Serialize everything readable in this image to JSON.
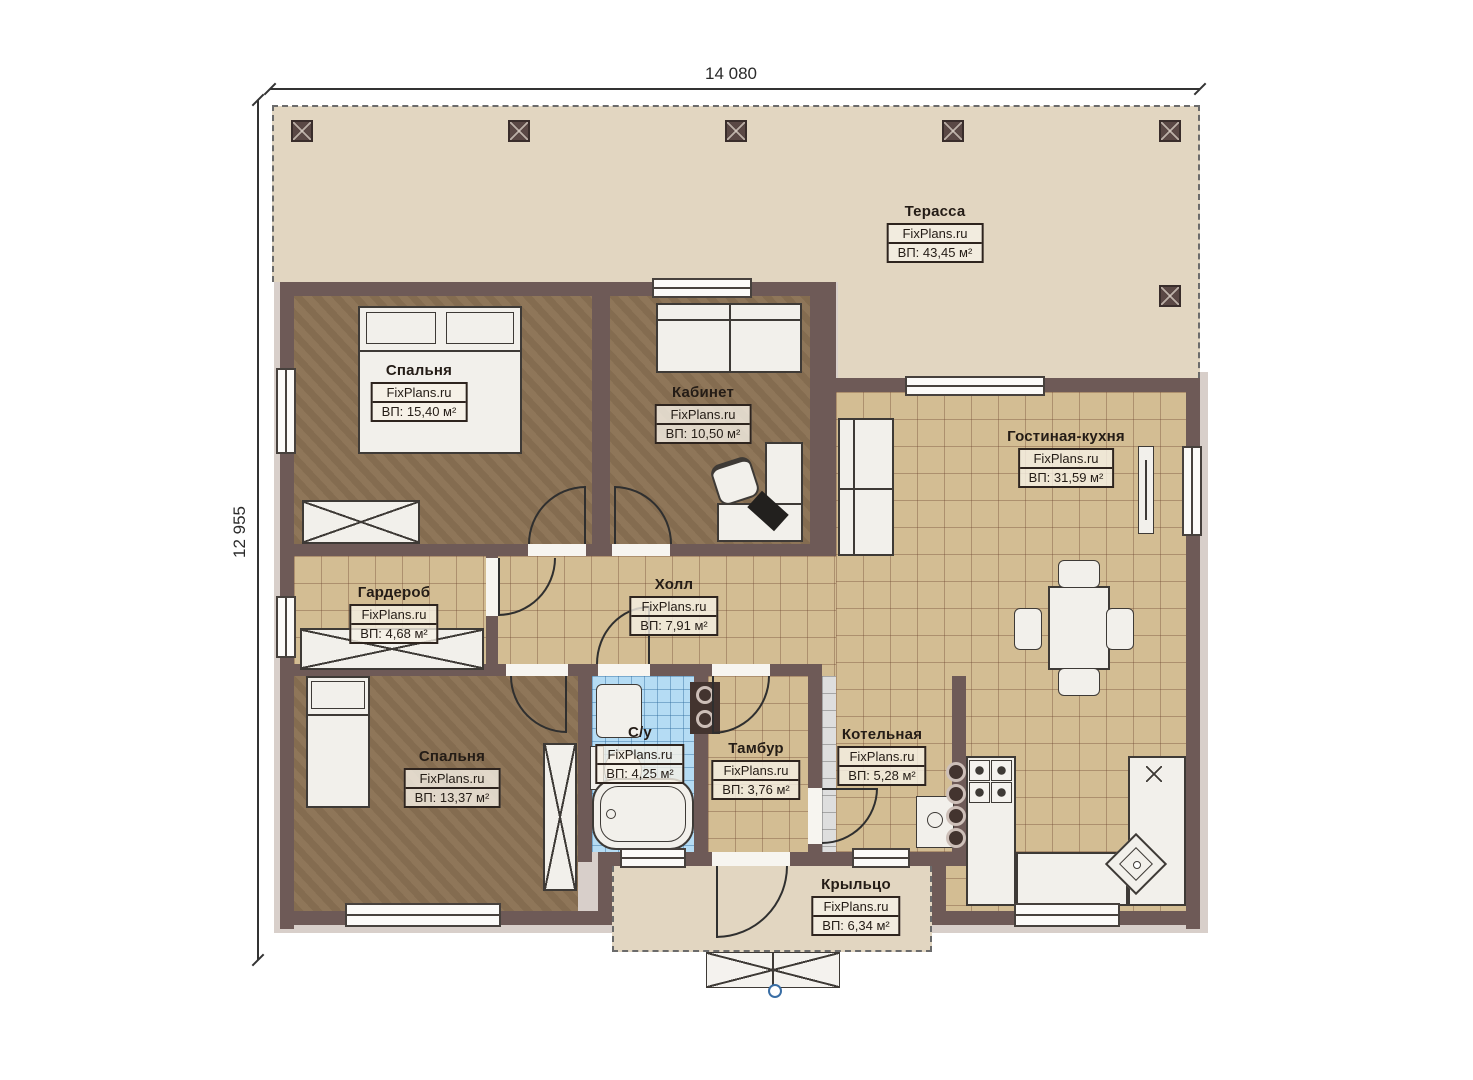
{
  "dimensions": {
    "width": "14 080",
    "height": "12 955"
  },
  "rooms": [
    {
      "id": "terrace",
      "name": "Терасса",
      "site": "FixPlans.ru",
      "area": "ВП: 43,45 м²"
    },
    {
      "id": "bedroom-1",
      "name": "Спальня",
      "site": "FixPlans.ru",
      "area": "ВП: 15,40 м²"
    },
    {
      "id": "office",
      "name": "Кабинет",
      "site": "FixPlans.ru",
      "area": "ВП: 10,50 м²"
    },
    {
      "id": "living-kitchen",
      "name": "Гостиная-кухня",
      "site": "FixPlans.ru",
      "area": "ВП: 31,59 м²"
    },
    {
      "id": "wardrobe",
      "name": "Гардероб",
      "site": "FixPlans.ru",
      "area": "ВП: 4,68 м²"
    },
    {
      "id": "hall",
      "name": "Холл",
      "site": "FixPlans.ru",
      "area": "ВП: 7,91 м²"
    },
    {
      "id": "bedroom-2",
      "name": "Спальня",
      "site": "FixPlans.ru",
      "area": "ВП: 13,37 м²"
    },
    {
      "id": "bathroom",
      "name": "С/у",
      "site": "FixPlans.ru",
      "area": "ВП: 4,25 м²"
    },
    {
      "id": "vestibule",
      "name": "Тамбур",
      "site": "FixPlans.ru",
      "area": "ВП: 3,76 м²"
    },
    {
      "id": "boiler-room",
      "name": "Котельная",
      "site": "FixPlans.ru",
      "area": "ВП: 5,28 м²"
    },
    {
      "id": "porch",
      "name": "Крыльцо",
      "site": "FixPlans.ru",
      "area": "ВП: 6,34 м²"
    }
  ],
  "colors": {
    "wall": "#6e5a57",
    "terrace": "#e2d6c1",
    "wood_floor": "#8b7254",
    "tile_tan": "#d3bd93",
    "tile_blue": "#b5dcf4",
    "tile_gray": "#dedede",
    "label_border": "#2e241e"
  }
}
